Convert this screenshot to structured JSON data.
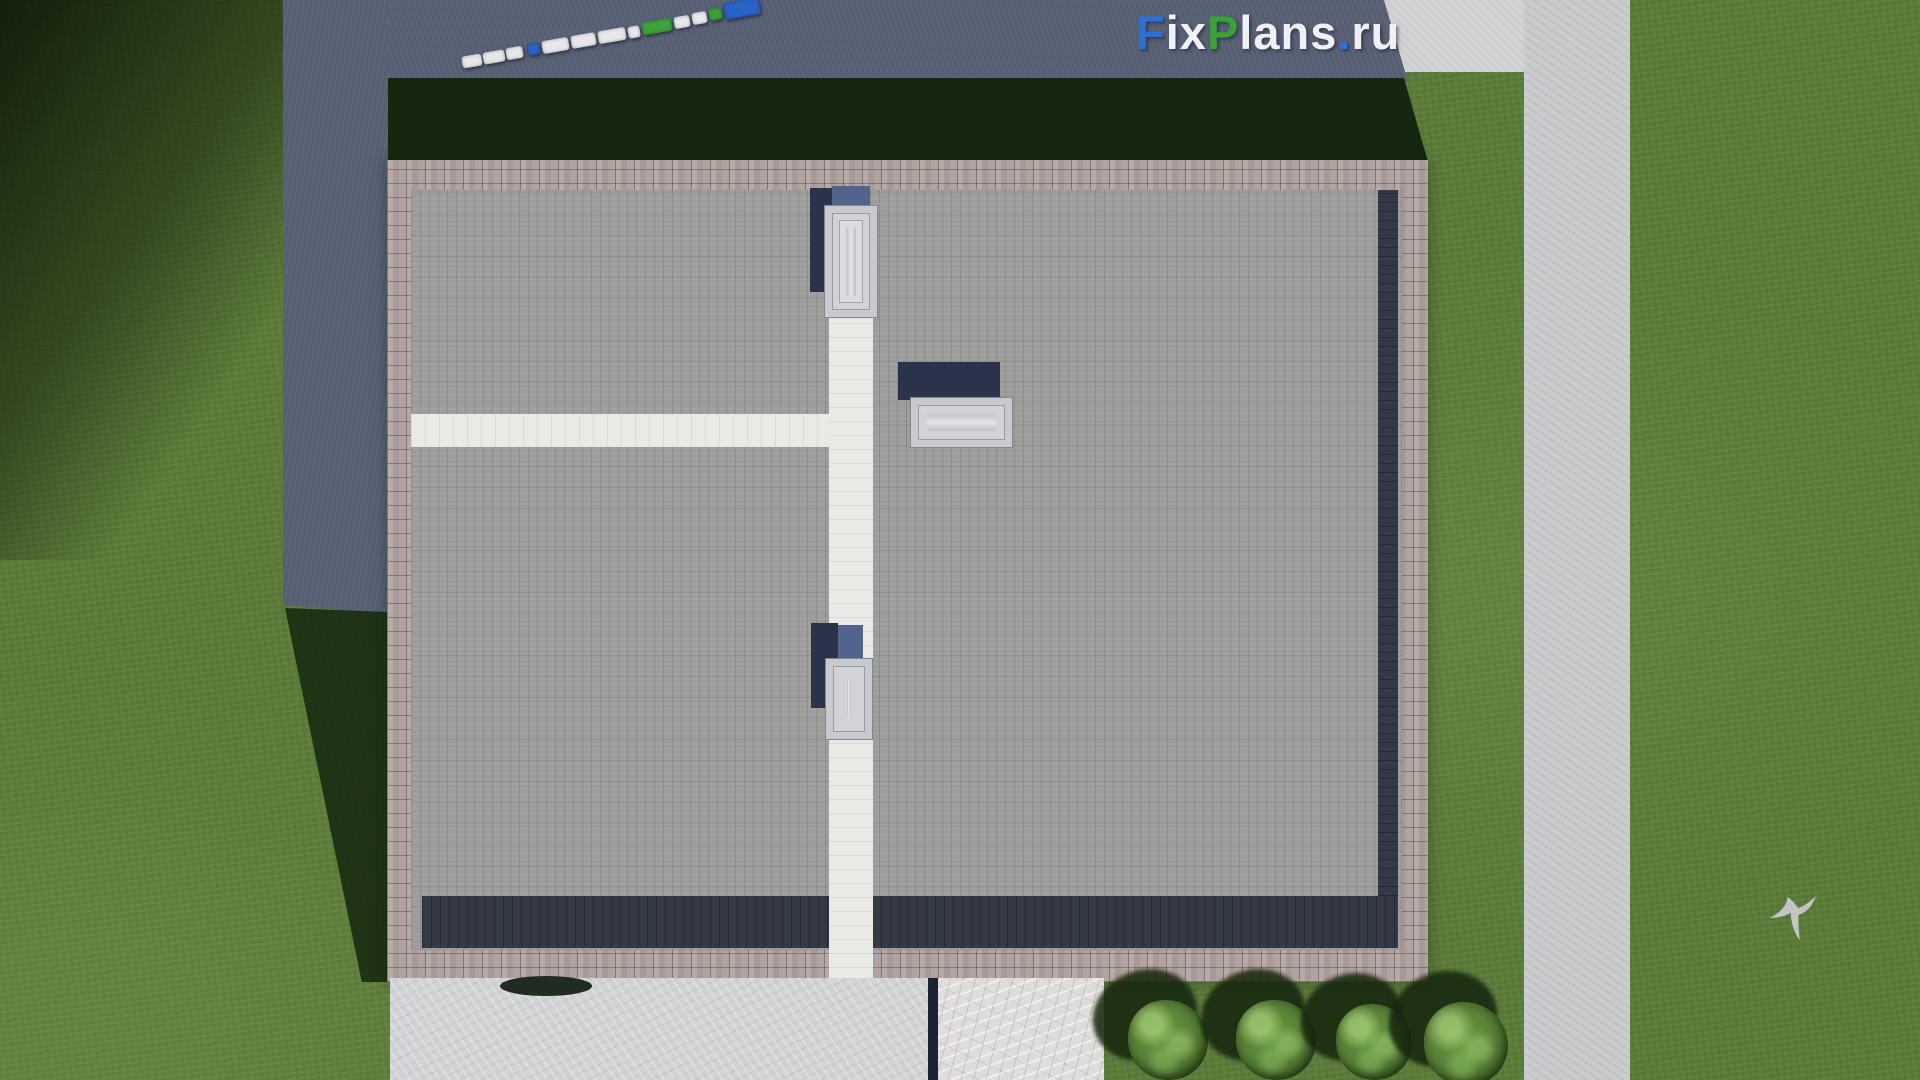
{
  "watermark": {
    "text": "FixPlans.ru",
    "segments": [
      {
        "text": "F",
        "color": "#2b6fd8"
      },
      {
        "text": "ix",
        "color": "#eef1f6"
      },
      {
        "text": "P",
        "color": "#39a336"
      },
      {
        "text": "lans",
        "color": "#eef1f6"
      },
      {
        "text": ".",
        "color": "#2b6fd8"
      },
      {
        "text": "ru",
        "color": "#eef1f6"
      }
    ]
  },
  "scene": {
    "description": "aerial top-down 3D render of a flat paver roof house with skylights, white roof paths, surrounding lawn, shadowed asphalt road with parked cars at top, concrete driveway, marble patio, four bushes, right sidewalk and a flying bird",
    "colors": {
      "grass": "#5b7b39",
      "grass-dark": "#16270f",
      "asphalt": "#565e72",
      "concrete": "#d2d3d5",
      "sidewalk": "#cbccce",
      "brick": "#b1a3a0",
      "pavers": "#9c9c9a",
      "dark-band": "#343a45",
      "path": "#e9e9e6",
      "marble": "#dedddb",
      "navy-shadow": "#2a3349",
      "slate-shadow": "#50648c",
      "bush": "#6e9b45",
      "bird": "#c8c9cb"
    },
    "cars": [
      {
        "x": 462,
        "y": 55,
        "w": 20,
        "h": 12,
        "color": "#e6e8ea"
      },
      {
        "x": 483,
        "y": 51,
        "w": 22,
        "h": 12,
        "color": "#e6e8ea"
      },
      {
        "x": 506,
        "y": 47,
        "w": 17,
        "h": 12,
        "color": "#e6e8ea"
      },
      {
        "x": 527,
        "y": 43,
        "w": 13,
        "h": 12,
        "color": "#2a63c8"
      },
      {
        "x": 542,
        "y": 39,
        "w": 27,
        "h": 13,
        "color": "#e6e8ea"
      },
      {
        "x": 571,
        "y": 34,
        "w": 25,
        "h": 13,
        "color": "#e6e8ea"
      },
      {
        "x": 598,
        "y": 29,
        "w": 28,
        "h": 13,
        "color": "#e6e8ea"
      },
      {
        "x": 628,
        "y": 26,
        "w": 12,
        "h": 12,
        "color": "#e6e8ea"
      },
      {
        "x": 642,
        "y": 20,
        "w": 30,
        "h": 13,
        "color": "#3aa33a"
      },
      {
        "x": 674,
        "y": 16,
        "w": 16,
        "h": 12,
        "color": "#e6e8ea"
      },
      {
        "x": 692,
        "y": 12,
        "w": 15,
        "h": 12,
        "color": "#e6e8ea"
      },
      {
        "x": 709,
        "y": 8,
        "w": 13,
        "h": 12,
        "color": "#3aa33a"
      },
      {
        "x": 724,
        "y": 0,
        "w": 36,
        "h": 17,
        "color": "#2a63c8"
      }
    ],
    "bushes": [
      {
        "cx": 1168,
        "cy": 1040,
        "r": 40
      },
      {
        "cx": 1276,
        "cy": 1040,
        "r": 40
      },
      {
        "cx": 1374,
        "cy": 1042,
        "r": 38
      },
      {
        "cx": 1466,
        "cy": 1044,
        "r": 42
      }
    ]
  }
}
